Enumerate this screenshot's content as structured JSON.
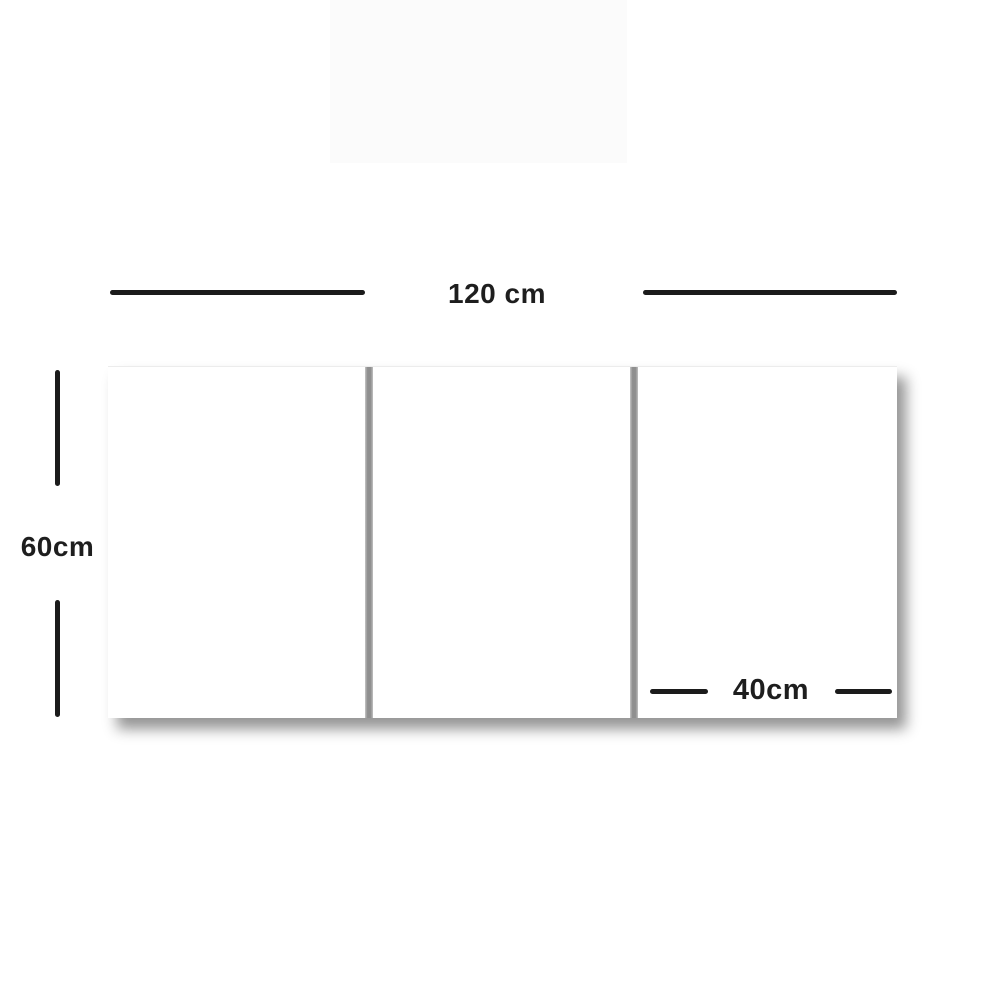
{
  "diagram": {
    "type": "product-dimension-diagram",
    "subject": "three-panel-canvas",
    "panel_count": 3,
    "dimensions": {
      "total_width": {
        "label": "120 cm",
        "value_cm": 120
      },
      "height": {
        "label": "60cm",
        "value_cm": 60
      },
      "panel_width": {
        "label": "40cm",
        "value_cm": 40
      }
    },
    "colors": {
      "background": "#ffffff",
      "panel_fill": "#ffffff",
      "dimension_line": "#1b1b1b",
      "label_text": "#1e1e1e",
      "panel_gap": "#8f8f8f",
      "shadow": "rgba(0,0,0,0.42)"
    }
  }
}
